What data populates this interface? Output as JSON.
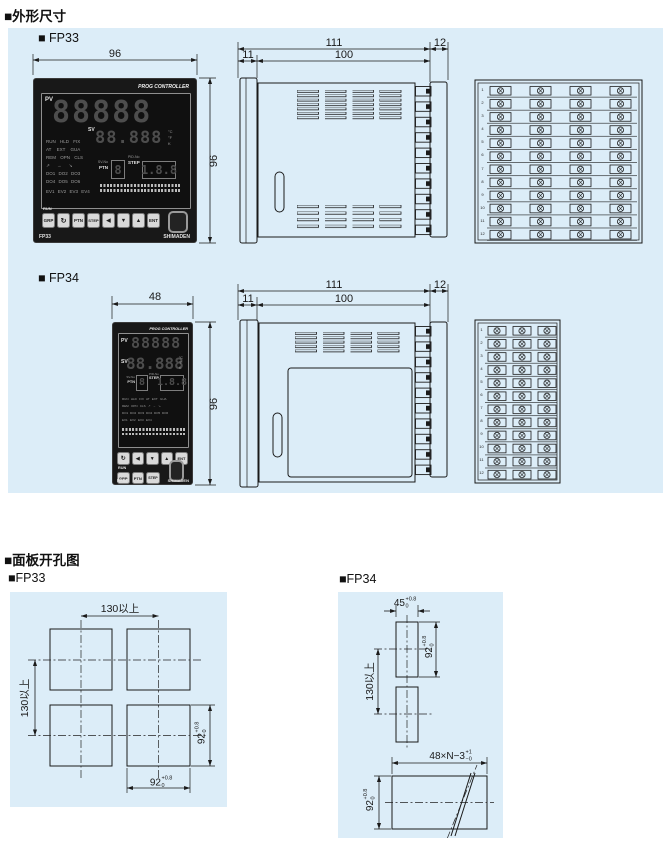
{
  "sections": {
    "dim_title": "■外形尺寸",
    "cutout_title": "■面板开孔图",
    "fp33_a": "■ FP33",
    "fp34_a": "■ FP34",
    "fp33_b": "■FP33",
    "fp34_b": "■FP34"
  },
  "fp33": {
    "front_w": "96",
    "front_h": "96",
    "side_total": "111",
    "side_term": "12",
    "side_bezel": "11",
    "side_depth": "100"
  },
  "fp34": {
    "front_w": "48",
    "front_h": "96",
    "side_total": "111",
    "side_term": "12",
    "side_bezel": "11",
    "side_depth": "100"
  },
  "rear_rows": [
    "1",
    "2",
    "3",
    "4",
    "5",
    "6",
    "7",
    "8",
    "9",
    "10",
    "11",
    "12"
  ],
  "panel": {
    "brand": "PROG CONTROLLER",
    "maker": "SHIMADEN",
    "pv": "PV",
    "sv": "SV",
    "units": [
      "°C",
      "°F",
      "K"
    ],
    "pv_digits": "88888",
    "sv_digits": "88.888",
    "ptn_no_label": "SV-No",
    "ptn_label": "PTN",
    "step_no_label": "PID-No",
    "step_label": "STEP",
    "ptn_digit": "8",
    "step_digits": "1.8.8",
    "run": "RUN",
    "fp33_model": "FP33",
    "fp34_model": "FP34",
    "fp33_status_rows": [
      "RUN HLD FIX",
      "AT EXT GUA",
      "REM OPN CLS",
      "↗ → ↘",
      "DO1 DO2 DO3",
      "DO4 DO5 DO6",
      "EV1 EV2 EV3 EV4"
    ],
    "fp34_status_rows": [
      "RUN HLD FIX AT EXT GUA",
      "REM OPN CLS ↗ → ↘",
      "DO1 DO2 DO3 DO4 DO5 DO6",
      "EV1 EV2 EV3 EV4"
    ],
    "fp33_buttons": [
      "GRP",
      "↻",
      "PTN",
      "STEP",
      "◀",
      "▼",
      "▲",
      "ENT"
    ],
    "fp34_buttons_row1": [
      "↻",
      "◀",
      "▼",
      "▲",
      "ENT"
    ],
    "fp34_buttons_row2": [
      "GRP",
      "PTN",
      "STEP"
    ]
  },
  "cutout_fp33": {
    "pitch_h": "130以上",
    "pitch_v": "130以上",
    "w_base": "92",
    "w_sup": "+0.8",
    "w_sub": "0",
    "h_base": "92",
    "h_sup": "+0.8",
    "h_sub": "0"
  },
  "cutout_fp34": {
    "w_base": "45",
    "w_sup": "+0.8",
    "w_sub": "0",
    "h_base": "92",
    "h_sup": "+0.8",
    "h_sub": "0",
    "pitch": "130以上",
    "gang_base": "48×N−3",
    "gang_sup": "+1",
    "gang_sub": "−0",
    "gang_h_base": "92",
    "gang_h_sup": "+0.8",
    "gang_h_sub": "0"
  }
}
